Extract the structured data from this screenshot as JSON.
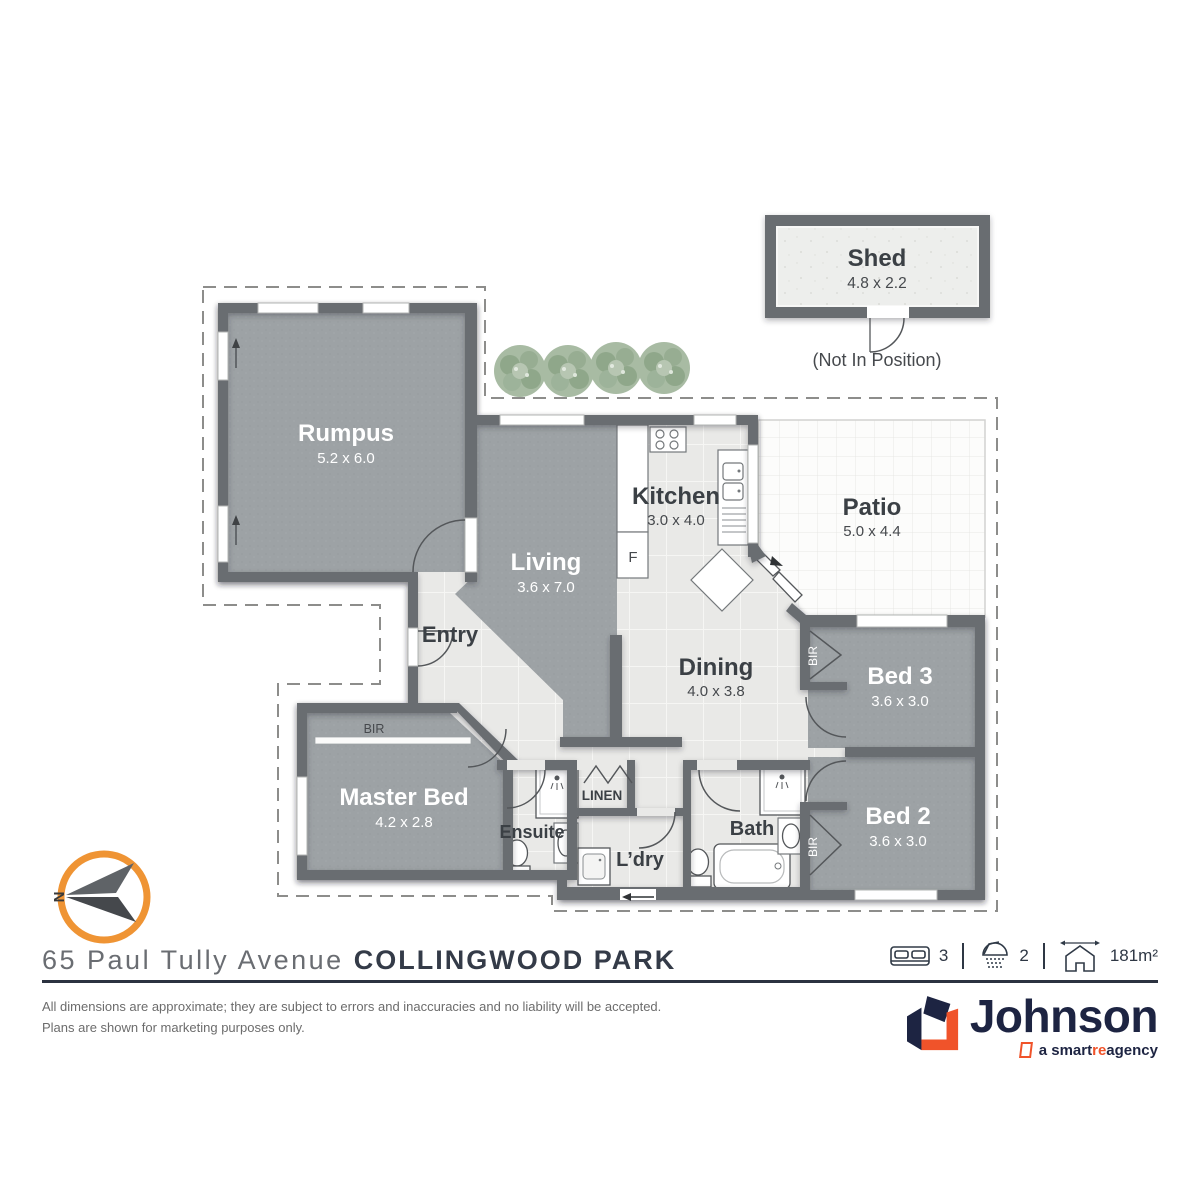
{
  "plan": {
    "rooms": {
      "rumpus": {
        "name": "Rumpus",
        "dims": "5.2 x 6.0"
      },
      "living": {
        "name": "Living",
        "dims": "3.6 x 7.0"
      },
      "kitchen": {
        "name": "Kitchen",
        "dims": "3.0 x 4.0"
      },
      "dining": {
        "name": "Dining",
        "dims": "4.0 x 3.8"
      },
      "patio": {
        "name": "Patio",
        "dims": "5.0 x 4.4"
      },
      "bed3": {
        "name": "Bed 3",
        "dims": "3.6 x 3.0"
      },
      "bed2": {
        "name": "Bed 2",
        "dims": "3.6 x 3.0"
      },
      "master": {
        "name": "Master Bed",
        "dims": "4.2 x 2.8"
      },
      "entry": {
        "name": "Entry"
      },
      "ensuite": {
        "name": "Ensuite"
      },
      "laundry": {
        "name": "L’dry"
      },
      "bath": {
        "name": "Bath"
      },
      "linen": {
        "name": "LINEN"
      }
    },
    "labels": {
      "fridge": "F",
      "bir": "BIR",
      "north": "N"
    },
    "shed": {
      "name": "Shed",
      "dims": "4.8 x 2.2",
      "note": "(Not In Position)"
    }
  },
  "footer": {
    "address": {
      "street": "65 Paul Tully Avenue",
      "suburb": "COLLINGWOOD PARK"
    },
    "stats": {
      "beds": "3",
      "baths": "2",
      "area": "181m²"
    },
    "disclaimer": [
      "All dimensions are approximate; they are subject to errors and inaccuracies and no liability will be accepted.",
      "Plans are shown for marketing purposes only."
    ],
    "logo": {
      "name": "Johnson",
      "tagline_pre": "a smart",
      "tagline_accent": "re",
      "tagline_post": " agency"
    }
  },
  "colors": {
    "wall": "#696d71",
    "carpet": "#9da2a5",
    "floor": "#e9e9e7",
    "compass_orange": "#ef9434",
    "brand_navy": "#1d2442",
    "brand_orange": "#f0532a"
  }
}
